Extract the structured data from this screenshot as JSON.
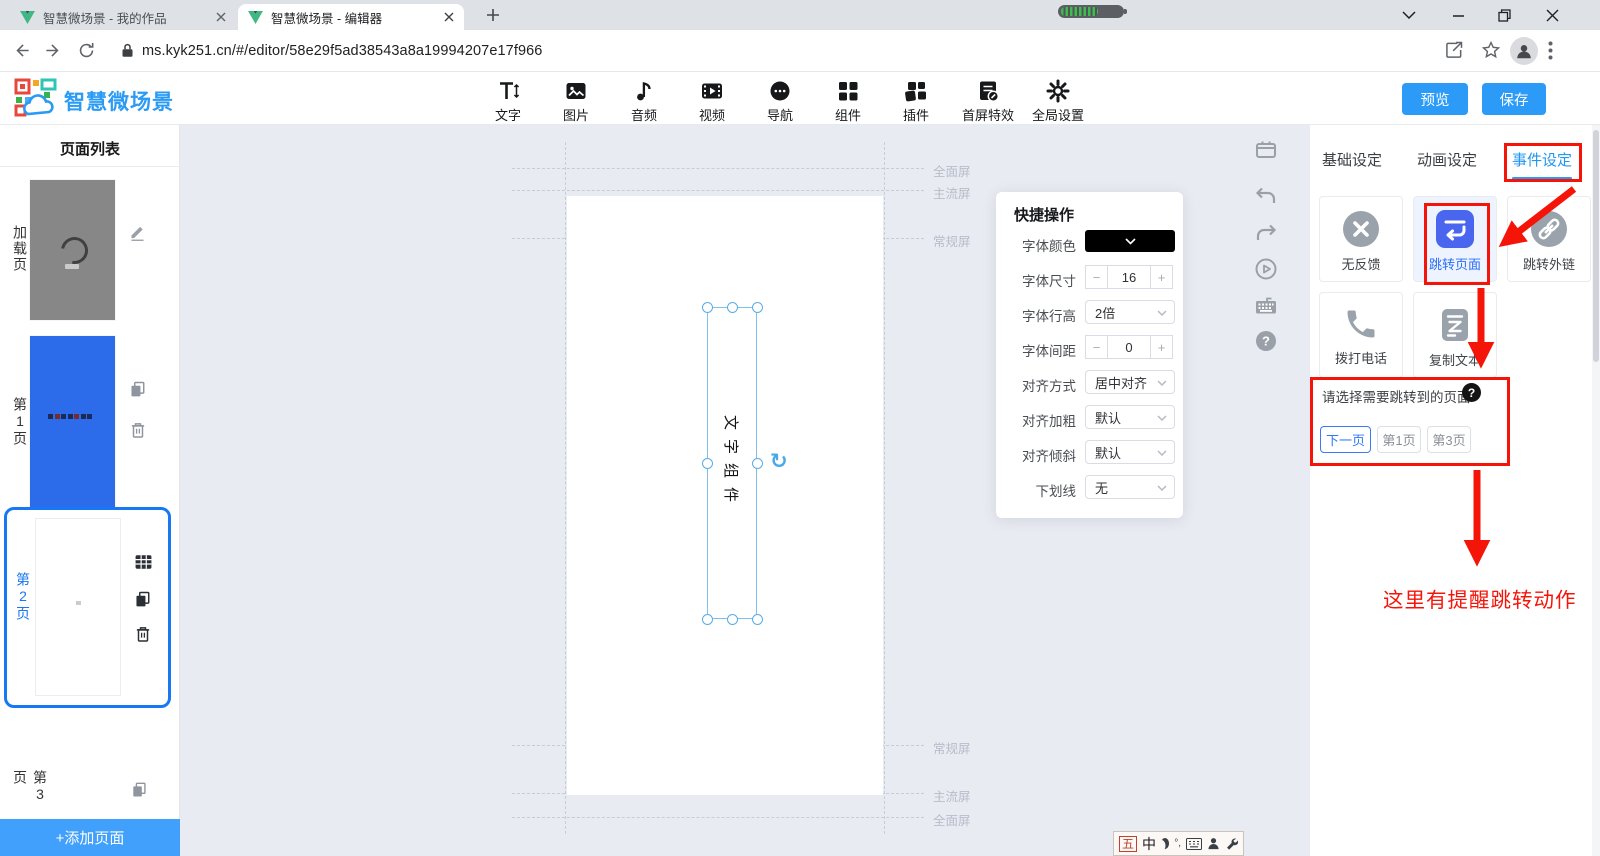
{
  "browser": {
    "tabs": [
      {
        "title": "智慧微场景 - 我的作品"
      },
      {
        "title": "智慧微场景 - 编辑器"
      }
    ],
    "url": "ms.kyk251.cn/#/editor/58e29f5ad38543a8a19994207e17f966"
  },
  "header": {
    "logo_text": "智慧微场景",
    "tools": [
      {
        "label": "文字"
      },
      {
        "label": "图片"
      },
      {
        "label": "音频"
      },
      {
        "label": "视频"
      },
      {
        "label": "导航"
      },
      {
        "label": "组件"
      },
      {
        "label": "插件"
      },
      {
        "label": "首屏特效"
      },
      {
        "label": "全局设置"
      }
    ],
    "preview_label": "预览",
    "save_label": "保存"
  },
  "sidebar": {
    "title": "页面列表",
    "pages": [
      {
        "label": "加载页"
      },
      {
        "label": "第1页"
      },
      {
        "label": "第2页"
      },
      {
        "label": "第3页"
      }
    ],
    "add_page_label": "+添加页面"
  },
  "canvas": {
    "guide_labels_top": [
      "全面屏",
      "主流屏",
      "常规屏"
    ],
    "guide_labels_bottom": [
      "常规屏",
      "主流屏",
      "全面屏"
    ],
    "component_text": "文字组件"
  },
  "quick_panel": {
    "title": "快捷操作",
    "stepper_minus": "−",
    "stepper_plus": "+",
    "rows": [
      {
        "label": "字体颜色",
        "value": "#000000"
      },
      {
        "label": "字体尺寸",
        "value": "16"
      },
      {
        "label": "字体行高",
        "value": "2倍"
      },
      {
        "label": "字体间距",
        "value": "0"
      },
      {
        "label": "对齐方式",
        "value": "居中对齐"
      },
      {
        "label": "对齐加粗",
        "value": "默认"
      },
      {
        "label": "对齐倾斜",
        "value": "默认"
      },
      {
        "label": "下划线",
        "value": "无"
      }
    ]
  },
  "right_panel": {
    "tabs": [
      {
        "label": "基础设定"
      },
      {
        "label": "动画设定"
      },
      {
        "label": "事件设定"
      }
    ],
    "active_tab": "事件设定",
    "event_cards": [
      {
        "label": "无反馈"
      },
      {
        "label": "跳转页面"
      },
      {
        "label": "跳转外链"
      },
      {
        "label": "拨打电话"
      },
      {
        "label": "复制文本"
      }
    ],
    "jump_title": "请选择需要跳转到的页面",
    "jump_options": [
      {
        "label": "下一页"
      },
      {
        "label": "第1页"
      },
      {
        "label": "第3页"
      }
    ],
    "selected_jump_option": "下一页",
    "annotation_text": "这里有提醒跳转动作"
  },
  "ime": {
    "scheme": "五",
    "mode": "中"
  },
  "colors": {
    "accent_blue": "#2b9bf7",
    "selected_border_blue": "#1678f2",
    "event_icon_blue": "#4b66ee",
    "annotation_red": "#f51408",
    "page1_thumb_blue": "#2c6cea"
  }
}
